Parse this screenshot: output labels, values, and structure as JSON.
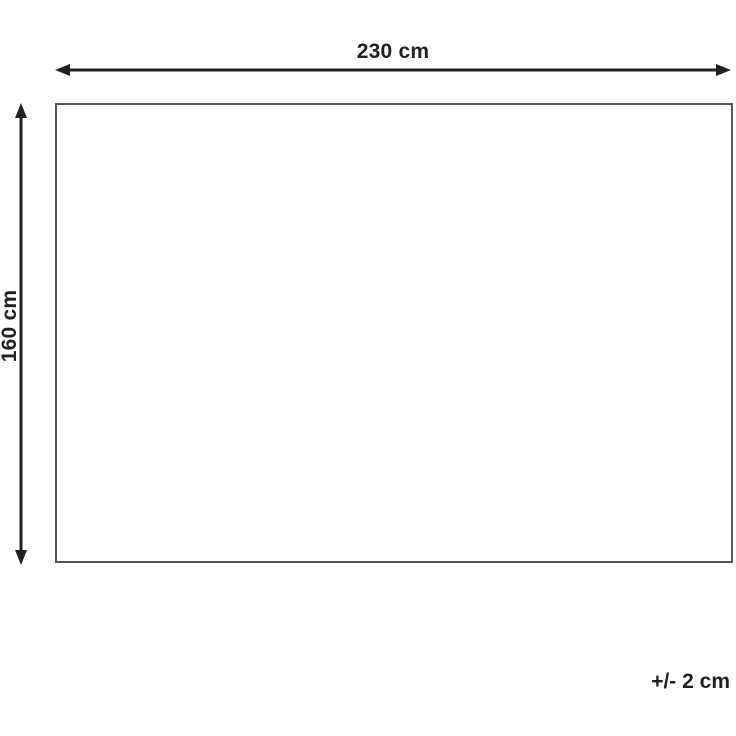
{
  "diagram": {
    "width_label": "230 cm",
    "height_label": "160 cm",
    "tolerance_label": "+/- 2 cm",
    "colors": {
      "arrow": "#231f20",
      "rectangle_border": "#55565a",
      "text": "#231f20",
      "background": "#ffffff"
    }
  }
}
